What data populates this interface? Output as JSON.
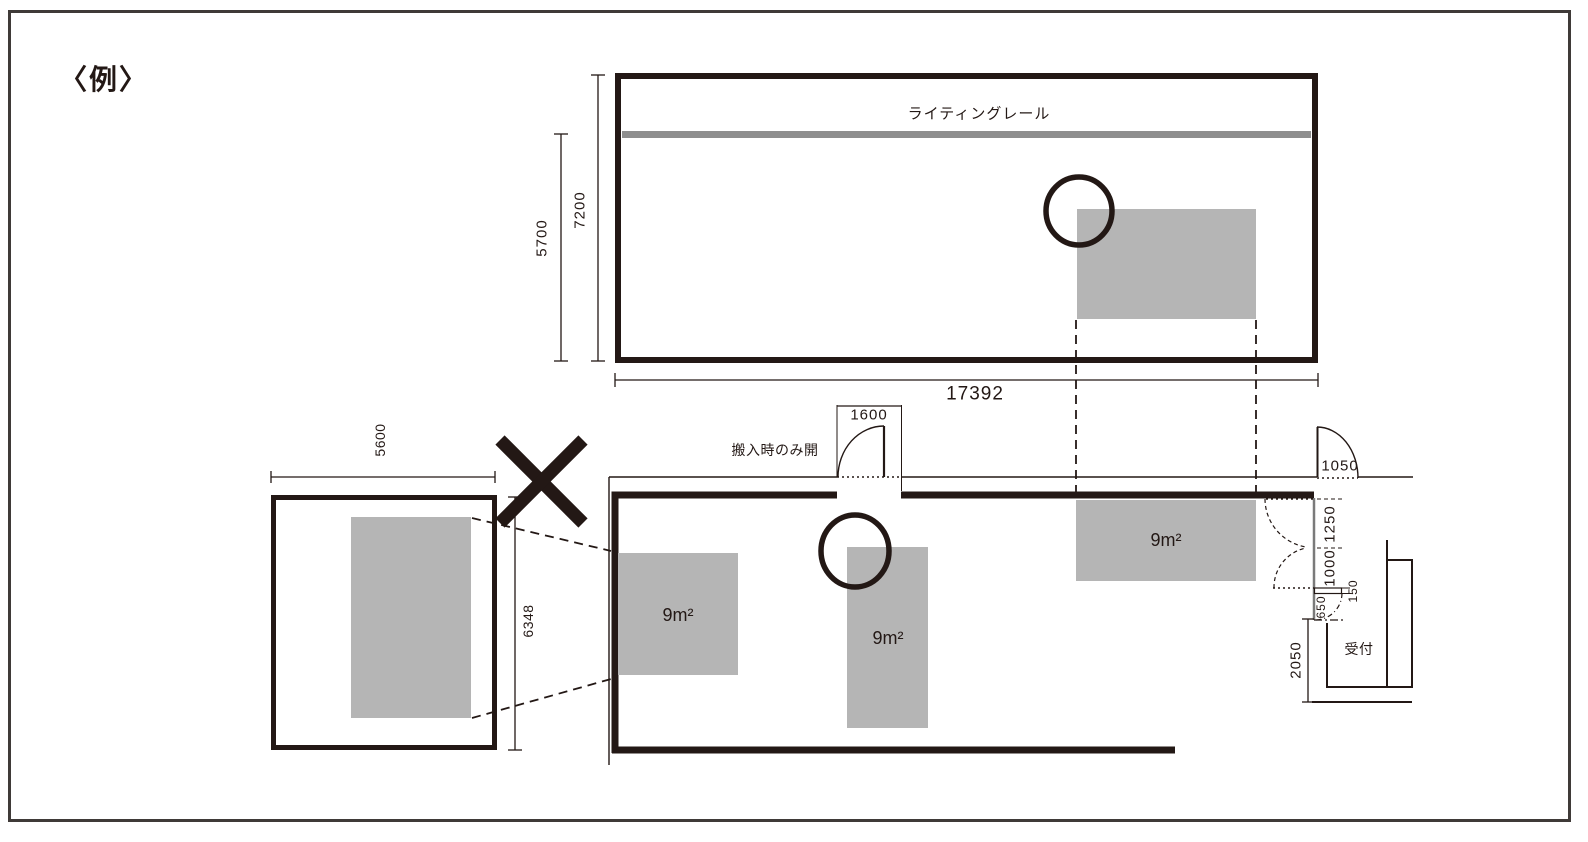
{
  "title_note": "〈例〉",
  "colors": {
    "ink": "#231815",
    "booth": "#b5b5b5",
    "rail": "#8e8e8e",
    "wall2": "#7a7a7a",
    "frame": "#3f3a38"
  },
  "upper_plan": {
    "lighting_rail_label": "ライティングレール",
    "dim_rail_to_wall": "5700",
    "dim_room_depth": "7200",
    "dim_room_width": "17392"
  },
  "lower_plan": {
    "delivery_door_note": "搬入時のみ開",
    "dim_delivery_door": "1600",
    "dim_entrance_door": "1050",
    "dim_door_leaf_upper": "1250",
    "dim_door_leaf_lower": "1000",
    "dim_wall_stub": "150",
    "dim_reception_door": "650",
    "dim_reception_depth": "2050",
    "reception_label": "受付",
    "booths": [
      {
        "label": "9m²"
      },
      {
        "label": "9m²"
      },
      {
        "label": "9m²"
      }
    ]
  },
  "side_room": {
    "dim_width": "5600",
    "dim_height": "6348"
  }
}
